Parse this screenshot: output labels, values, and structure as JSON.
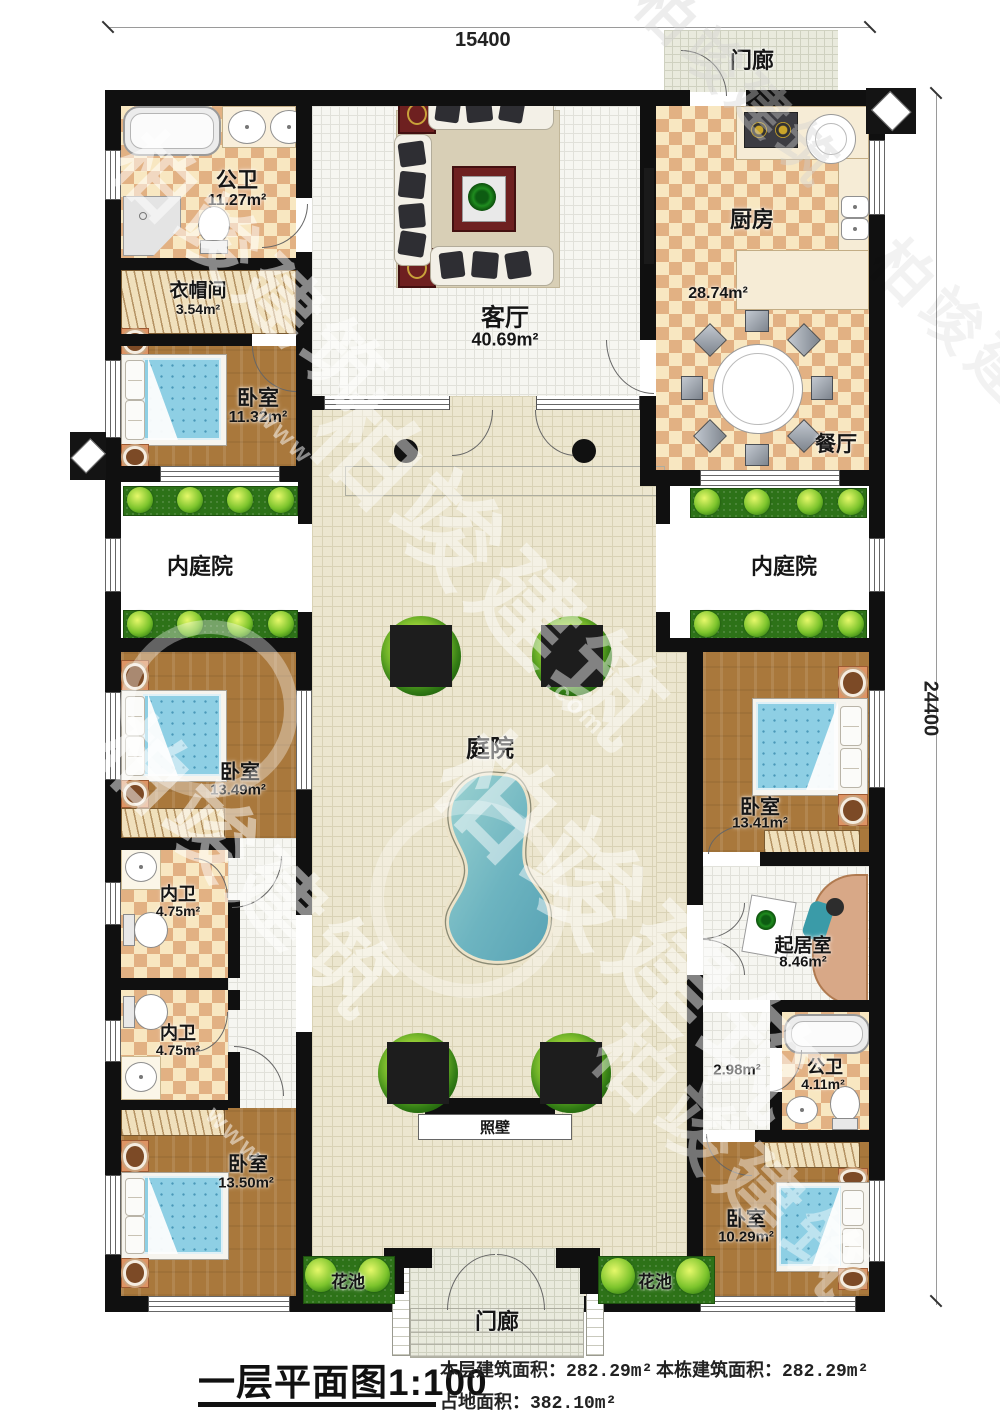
{
  "dim_top": "15400",
  "dim_right": "24400",
  "rooms": {
    "porch_top": "门廊",
    "bath_top": {
      "n": "公卫",
      "a": "11.27m²"
    },
    "cloak": {
      "n": "衣帽间",
      "a": "3.54m²"
    },
    "bed_tl": {
      "n": "卧室",
      "a": "11.32m²"
    },
    "living": {
      "n": "客厅",
      "a": "40.69m²"
    },
    "kitchen": {
      "n": "厨房",
      "a": "28.74m²"
    },
    "dining": {
      "n": "餐厅"
    },
    "inner_left": "内庭院",
    "inner_right": "内庭院",
    "courtyard": "庭院",
    "bed_ml": {
      "n": "卧室",
      "a": "13.49m²"
    },
    "bath_ml1": {
      "n": "内卫",
      "a": "4.75m²"
    },
    "bath_ml2": {
      "n": "内卫",
      "a": "4.75m²"
    },
    "bed_bl": {
      "n": "卧室",
      "a": "13.50m²"
    },
    "bed_mr": {
      "n": "卧室",
      "a": "13.41m²"
    },
    "sitting": {
      "n": "起居室",
      "a": "8.46m²"
    },
    "hall_br": {
      "a": "2.98m²"
    },
    "bath_br": {
      "n": "公卫",
      "a": "4.11m²"
    },
    "bed_br": {
      "n": "卧室",
      "a": "10.29m²"
    },
    "screen_wall": "照壁",
    "flower_left": "花池",
    "flower_right": "花池",
    "porch_bottom": "门廊"
  },
  "footer": {
    "title": "一层平面图1:100",
    "stat1_label": "本层建筑面积：",
    "stat1_value": "282.29m²",
    "stat2_label": "本栋建筑面积：",
    "stat2_value": "282.29m²",
    "stat3_label": "占地面积：",
    "stat3_value": "382.10m²"
  },
  "watermark": {
    "text": "柏竣建筑",
    "www": "www",
    "com": ".com"
  }
}
